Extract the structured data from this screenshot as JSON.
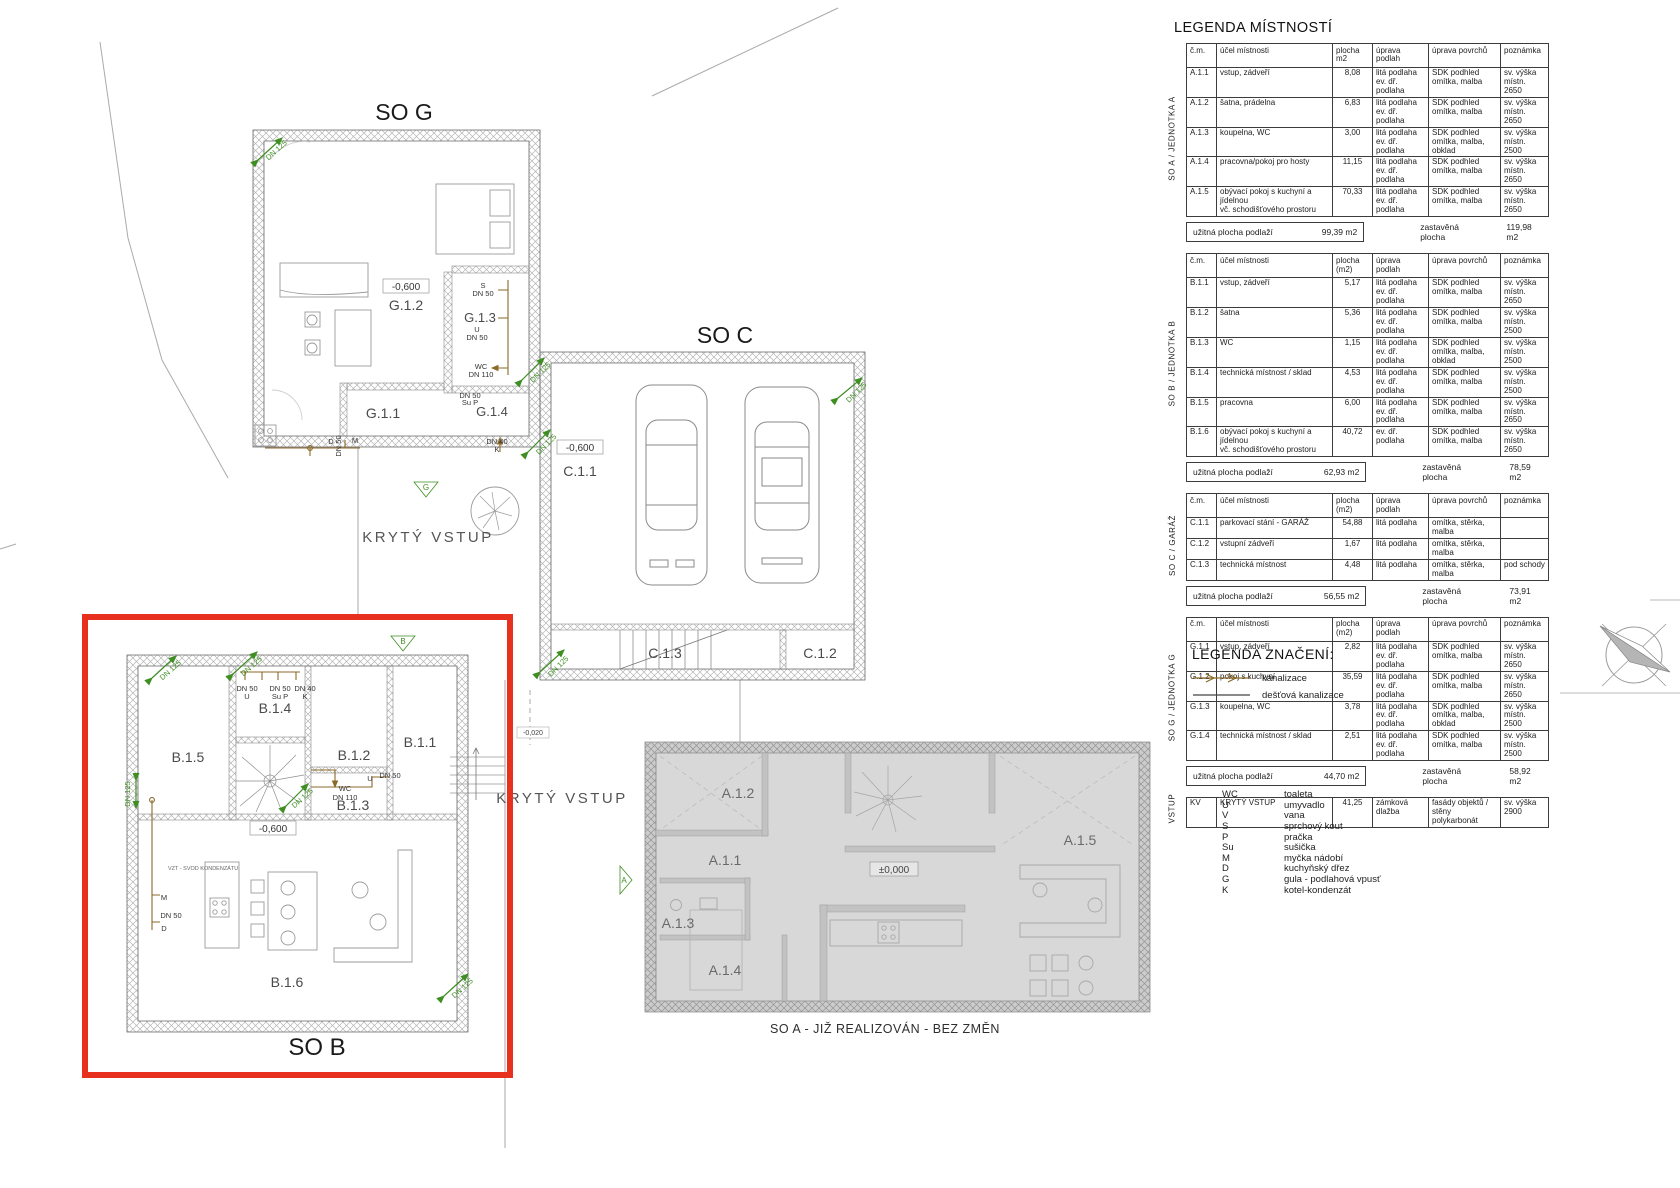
{
  "legend": {
    "title": "LEGENDA MÍSTNOSTÍ",
    "tables": [
      {
        "side": "SO  A  / JEDNOTKA A",
        "headers": [
          "č.m.",
          "účel místnosti",
          "plocha m2",
          "úprava podlah",
          "úprava povrchů",
          "poznámka"
        ],
        "rows": [
          [
            "A.1.1",
            "vstup, zádveří",
            "8,08",
            "litá podlaha\nev. dř. podlaha",
            "SDK podhled\nomítka, malba",
            "sv. výška místn.\n2650"
          ],
          [
            "A.1.2",
            "šatna, prádelna",
            "6,83",
            "litá podlaha\nev. dř. podlaha",
            "SDK podhled\nomítka, malba",
            "sv. výška místn.\n2650"
          ],
          [
            "A.1.3",
            "koupelna, WC",
            "3,00",
            "litá podlaha\nev. dř. podlaha",
            "SDK podhled\nomítka, malba, obklad",
            "sv. výška místn.\n2500"
          ],
          [
            "A.1.4",
            "pracovna/pokoj pro hosty",
            "11,15",
            "litá podlaha\nev. dř. podlaha",
            "SDK podhled\nomítka, malba",
            "sv. výška místn.\n2650"
          ],
          [
            "A.1.5",
            "obývací pokoj s kuchyní a jídelnou\nvč. schodišťového prostoru",
            "70,33",
            "litá podlaha\nev. dř. podlaha",
            "SDK podhled\nomítka, malba",
            "sv. výška místn.\n2650"
          ]
        ],
        "summary": {
          "left_label": "užitná plocha podlaží",
          "left_value": "99,39 m2",
          "right_label": "zastavěná plocha",
          "right_value": "119,98 m2"
        }
      },
      {
        "side": "SO  B / JEDNOTKA B",
        "headers": [
          "č.m.",
          "účel místnosti",
          "plocha (m2)",
          "úprava podlah",
          "úprava povrchů",
          "poznámka"
        ],
        "rows": [
          [
            "B.1.1",
            "vstup, zádveří",
            "5,17",
            "litá podlaha\nev. dř. podlaha",
            "SDK podhled\nomítka, malba",
            "sv. výška místn.\n2650"
          ],
          [
            "B.1.2",
            "šatna",
            "5,36",
            "litá podlaha\nev. dř. podlaha",
            "SDK podhled\nomítka, malba",
            "sv. výška místn.\n2500"
          ],
          [
            "B.1.3",
            "WC",
            "1,15",
            "litá podlaha\nev. dř. podlaha",
            "SDK podhled\nomítka, malba, obklad",
            "sv. výška místn.\n2500"
          ],
          [
            "B.1.4",
            "technická místnost / sklad",
            "4,53",
            "litá podlaha\nev. dř. podlaha",
            "SDK podhled\nomítka, malba",
            "sv. výška místn.\n2500"
          ],
          [
            "B.1.5",
            "pracovna",
            "6,00",
            "litá podlaha\nev. dř. podlaha",
            "SDK podhled\nomítka, malba",
            "sv. výška místn.\n2650"
          ],
          [
            "B.1.6",
            "obývací pokoj s kuchyní a jídelnou\nvč. schodišťového prostoru",
            "40,72",
            "ev. dř. podlaha",
            "SDK podhled\nomítka, malba",
            "sv. výška místn.\n2650"
          ]
        ],
        "summary": {
          "left_label": "užitná plocha podlaží",
          "left_value": "62,93 m2",
          "right_label": "zastavěná plocha",
          "right_value": "78,59 m2"
        }
      },
      {
        "side": "SO C /  GARÁŽ",
        "headers": [
          "č.m.",
          "účel místnosti",
          "plocha (m2)",
          "úprava podlah",
          "úprava povrchů",
          "poznámka"
        ],
        "rows": [
          [
            "C.1.1",
            "parkovací stání - GARÁŽ",
            "54,88",
            "litá podlaha",
            "omítka, stěrka, malba",
            ""
          ],
          [
            "C.1.2",
            "vstupní zádveří",
            "1,67",
            "litá podlaha",
            "omítka, stěrka, malba",
            ""
          ],
          [
            "C.1.3",
            "technická místnost",
            "4,48",
            "litá podlaha",
            "omítka, stěrka, malba",
            "pod schody"
          ]
        ],
        "summary": {
          "left_label": "užitná plocha podlaží",
          "left_value": "56,55 m2",
          "right_label": "zastavěná plocha",
          "right_value": "73,91 m2"
        }
      },
      {
        "side": "SO  G / JEDNOTKA G",
        "headers": [
          "č.m.",
          "účel místnosti",
          "plocha (m2)",
          "úprava podlah",
          "úprava povrchů",
          "poznámka"
        ],
        "rows": [
          [
            "G.1.1",
            "vstup, zádveří",
            "2,82",
            "litá podlaha\nev. dř. podlaha",
            "SDK podhled\nomítka, malba",
            "sv. výška místn.\n2650"
          ],
          [
            "G.1.2",
            "pokoj s kuchyní",
            "35,59",
            "litá podlaha\nev. dř. podlaha",
            "SDK podhled\nomítka, malba",
            "sv. výška místn.\n2650"
          ],
          [
            "G.1.3",
            "koupelna, WC",
            "3,78",
            "litá podlaha\nev. dř. podlaha",
            "SDK podhled\nomítka, malba, obklad",
            "sv. výška místn.\n2500"
          ],
          [
            "G.1.4",
            "technická místnost / sklad",
            "2,51",
            "litá podlaha\nev. dř. podlaha",
            "SDK podhled\nomítka, malba",
            "sv. výška místn.\n2500"
          ]
        ],
        "summary": {
          "left_label": "užitná plocha podlaží",
          "left_value": "44,70 m2",
          "right_label": "zastavěná plocha",
          "right_value": "58,92 m2"
        }
      },
      {
        "side": "VSTUP",
        "headers": null,
        "rows": [
          [
            "KV",
            "KRYTÝ VSTUP",
            "41,25",
            "zámková\ndlažba",
            "fasády objektů /\nstěny polykarbonát",
            "sv. výška\n2900"
          ]
        ],
        "summary": null
      }
    ]
  },
  "symbols_legend": {
    "title": "LEGENDA ZNAČENÍ:",
    "items": [
      {
        "label": "kanalizace",
        "type": "sewer-arrow"
      },
      {
        "label": "dešťová kanalizace",
        "type": "plain-line"
      }
    ]
  },
  "abbreviations": [
    {
      "key": "WC",
      "label": "toaleta"
    },
    {
      "key": "U",
      "label": "umyvadlo"
    },
    {
      "key": "V",
      "label": "vana"
    },
    {
      "key": "S",
      "label": "sprchový kout"
    },
    {
      "key": "P",
      "label": "pračka"
    },
    {
      "key": "Su",
      "label": "sušička"
    },
    {
      "key": "M",
      "label": "myčka nádobí"
    },
    {
      "key": "D",
      "label": "kuchyňský dřez"
    },
    {
      "key": "G",
      "label": "gula - podlahová vpusť"
    },
    {
      "key": "K",
      "label": "kotel-kondenzát"
    }
  ],
  "plan": {
    "buildings": {
      "so_g": "SO G",
      "so_c": "SO C",
      "so_b": "SO B"
    },
    "so_a_note": "SO A - JIŽ REALIZOVÁN - BEZ ZMĚN",
    "covered_entry": "KRYTÝ VSTUP",
    "levels": {
      "minus600": "-0,600",
      "zero": "±0,000",
      "minus020": "-0,020"
    },
    "rooms": {
      "g": [
        "G.1.1",
        "G.1.2",
        "G.1.3",
        "G.1.4"
      ],
      "c": [
        "C.1.1",
        "C.1.2",
        "C.1.3"
      ],
      "b": [
        "B.1.1",
        "B.1.2",
        "B.1.3",
        "B.1.4",
        "B.1.5",
        "B.1.6"
      ],
      "a": [
        "A.1.1",
        "A.1.2",
        "A.1.3",
        "A.1.4",
        "A.1.5"
      ]
    },
    "pipes": {
      "dn125": "DN 125",
      "dn110": "DN 110",
      "dn50": "DN 50",
      "dn40": "DN 40"
    },
    "fixtures": {
      "wc": "WC",
      "u": "U",
      "s": "S",
      "p": "P",
      "su": "Su  P",
      "m": "M",
      "d": "D",
      "k": "K"
    },
    "markers": {
      "a": "A",
      "b": "B",
      "g": "G"
    },
    "vzt_note": "VZT - SVOD KONDENZÁTU"
  },
  "colors": {
    "red_highlight": "#e8301e",
    "pipe_green": "#3e8e22",
    "pipe_brown": "#8a6a28",
    "gray_fill": "#d8d8d8"
  }
}
